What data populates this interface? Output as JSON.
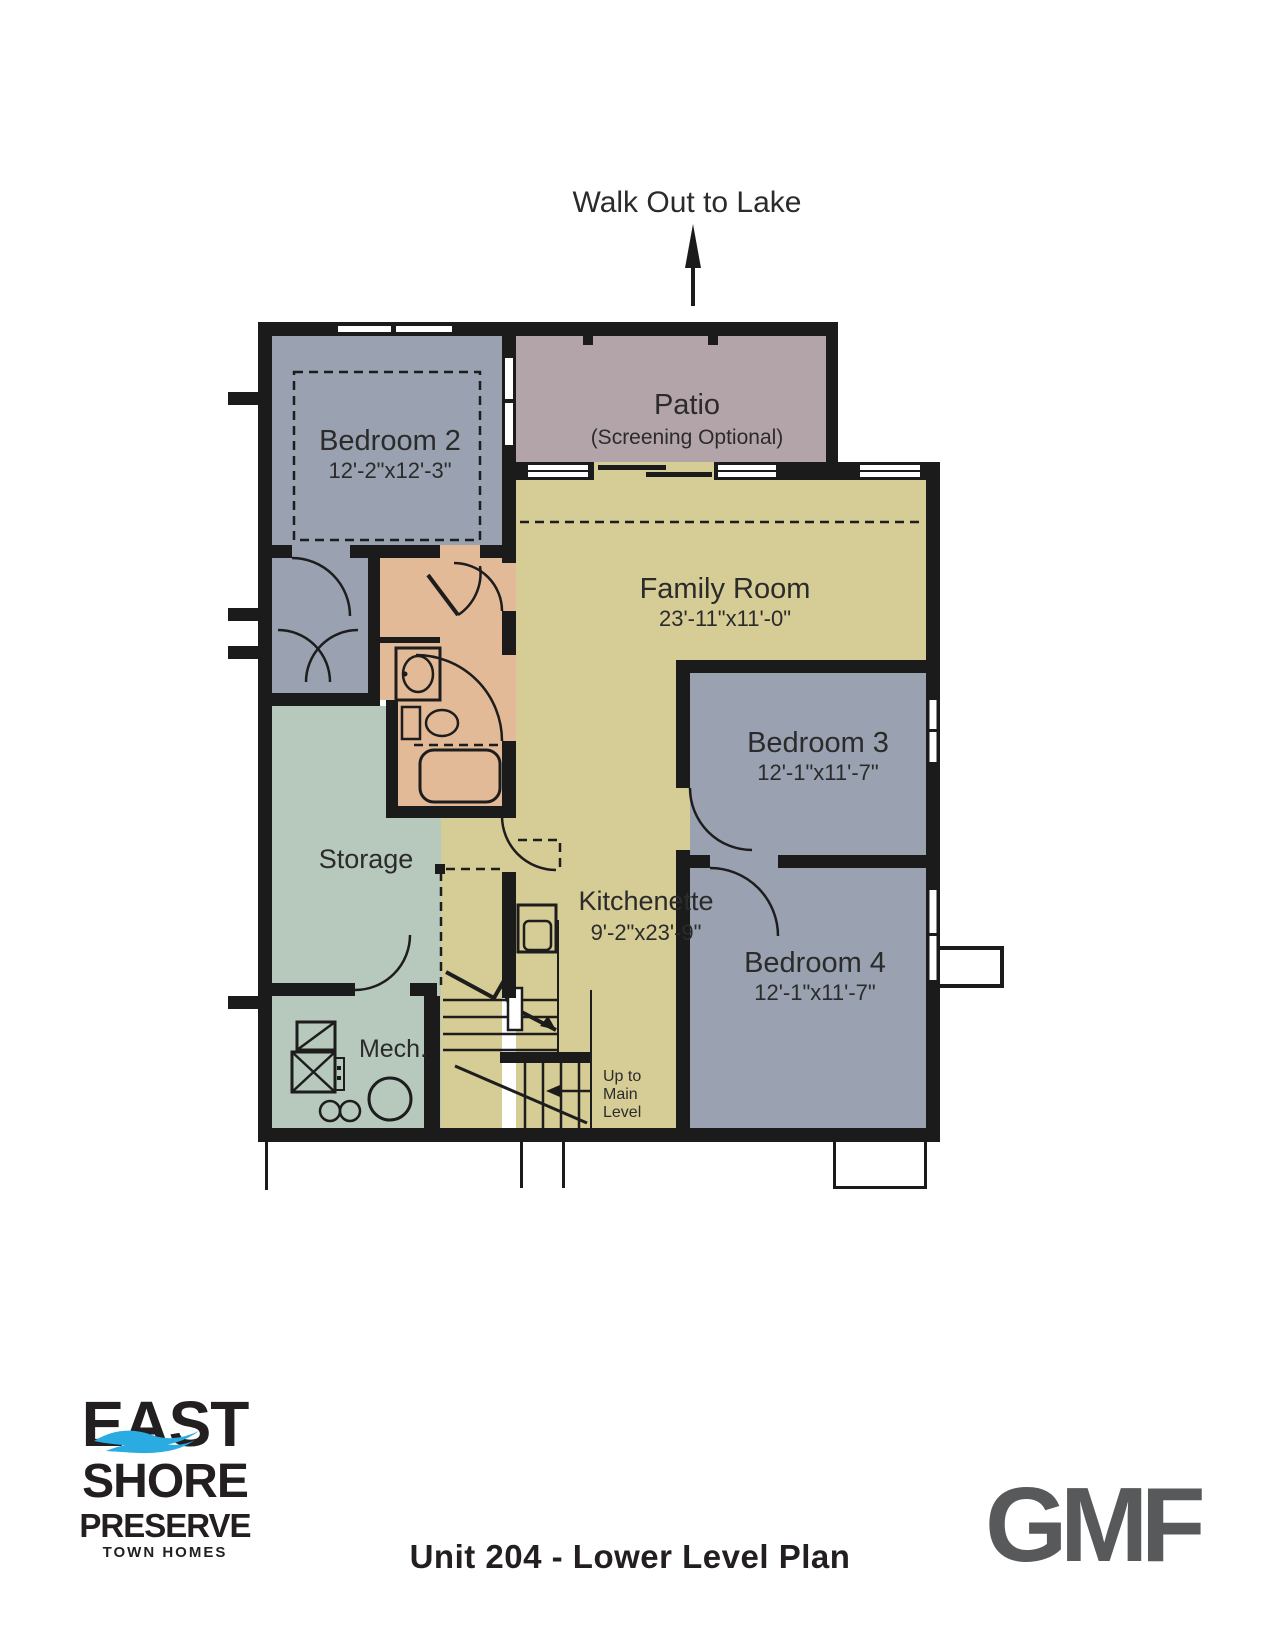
{
  "header": {
    "walkout_label": "Walk Out to Lake"
  },
  "rooms": {
    "patio": {
      "name": "Patio",
      "note": "(Screening Optional)"
    },
    "bedroom2": {
      "name": "Bedroom 2",
      "dims": "12'-2\"x12'-3\""
    },
    "family_room": {
      "name": "Family Room",
      "dims": "23'-11\"x11'-0\""
    },
    "bedroom3": {
      "name": "Bedroom 3",
      "dims": "12'-1\"x11'-7\""
    },
    "bedroom4": {
      "name": "Bedroom 4",
      "dims": "12'-1\"x11'-7\""
    },
    "storage": {
      "name": "Storage"
    },
    "kitchenette": {
      "name": "Kitchenette",
      "dims": "9'-2\"x23'-9\""
    },
    "mech": {
      "name": "Mech."
    },
    "stairs": {
      "note_line1": "Up to",
      "note_line2": "Main",
      "note_line3": "Level"
    }
  },
  "footer": {
    "title": "Unit 204 - Lower Level Plan"
  },
  "logos": {
    "east_shore": {
      "line1": "EAST",
      "line2": "SHORE",
      "line3": "PRESERVE",
      "line4": "TOWN HOMES"
    },
    "gmf": {
      "text": "GMF"
    }
  },
  "colors": {
    "bedroom_fill": "#9aa2b1",
    "patio_fill": "#b3a4a9",
    "living_fill": "#d6cc95",
    "storage_fill": "#b7c8bd",
    "bath_fill": "#e3ba97",
    "wall": "#1b1b1b",
    "logo_wave_blue": "#2aabe2",
    "gmf_gray": "#58595b"
  }
}
